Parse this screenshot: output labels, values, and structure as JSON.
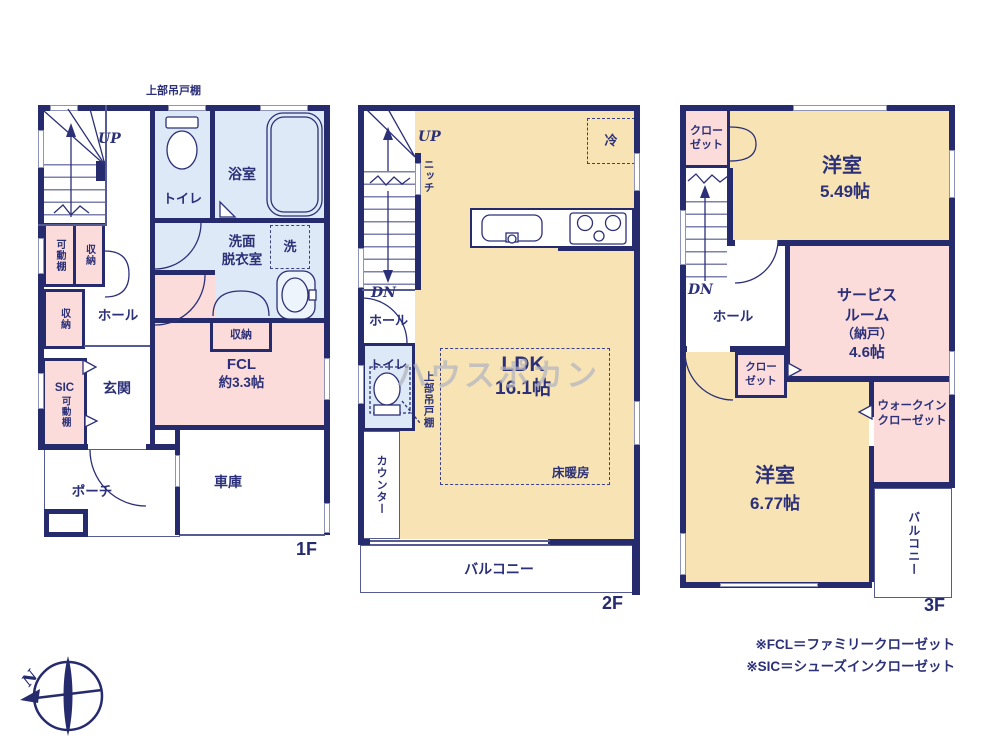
{
  "colors": {
    "wall": "#262b6d",
    "cream": "#f7e3b3",
    "pink": "#fbdcda",
    "blue": "#dde9f6",
    "text": "#2b3078",
    "watermark": "#b3b4c0"
  },
  "f1": {
    "floor_label": "1F",
    "cupboard_note": "上部吊戸棚",
    "up": "UP",
    "toilet": "トイレ",
    "bath": "浴室",
    "washroom": "洗面\n脱衣室",
    "laundry": "洗",
    "shelf_a": "可動棚",
    "closet_a": "収納",
    "closet_b": "収納",
    "hall": "ホール",
    "sic": "SIC",
    "shelf_b": "可動棚",
    "entrance": "玄関",
    "closet_c": "収納",
    "fcl_name": "FCL",
    "fcl_size": "約3.3帖",
    "porch": "ポーチ",
    "garage": "車庫"
  },
  "f2": {
    "floor_label": "2F",
    "up": "UP",
    "niche": "ニッチ",
    "fridge": "冷",
    "dn": "DN",
    "hall": "ホール",
    "toilet": "トイレ",
    "cupboard": "上部吊戸棚",
    "counter": "カウンター",
    "ldk": "LDK",
    "ldk_size": "16.1帖",
    "floor_heating": "床暖房",
    "balcony": "バルコニー"
  },
  "f3": {
    "floor_label": "3F",
    "closet_top": "クロー\nゼット",
    "room1": "洋室",
    "room1_size": "5.49帖",
    "dn": "DN",
    "hall": "ホール",
    "service_room": "サービス\nルーム",
    "service_room_note": "（納戸）",
    "service_room_size": "4.6帖",
    "closet_mid": "クロー\nゼット",
    "room2": "洋室",
    "room2_size": "6.77帖",
    "wic": "ウォークイン\nクローゼット",
    "balcony": "バルコニー"
  },
  "notes": [
    "※FCL＝ファミリークローゼット",
    "※SIC＝シューズインクローゼット"
  ],
  "compass_n": "N",
  "watermark": "ハウスポカン"
}
